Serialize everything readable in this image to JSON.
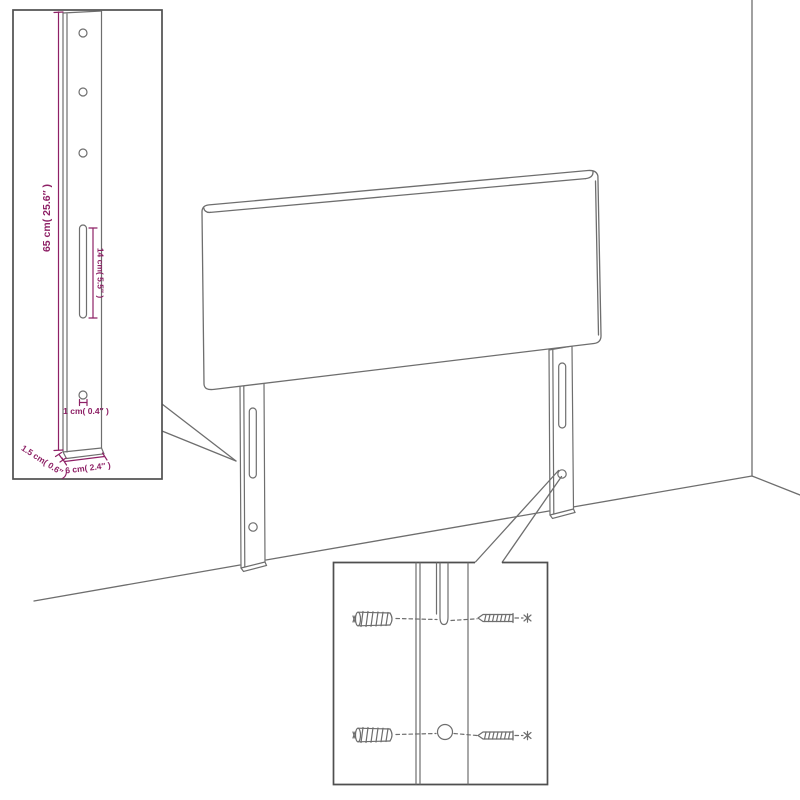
{
  "dimension_labels": {
    "leg_height": "65 cm( 25.6″ )",
    "slot_length": "14 cm( 5.5″ )",
    "hole_diameter": "1 cm( 0.4″ )",
    "leg_thickness": "1.5 cm( 0.6″ )",
    "leg_width": "6 cm( 2.4″ )"
  },
  "colors": {
    "dimension": "#8e2166",
    "line": "#6e6e6e",
    "inset_border": "#4f4f4f",
    "background": "#ffffff"
  }
}
